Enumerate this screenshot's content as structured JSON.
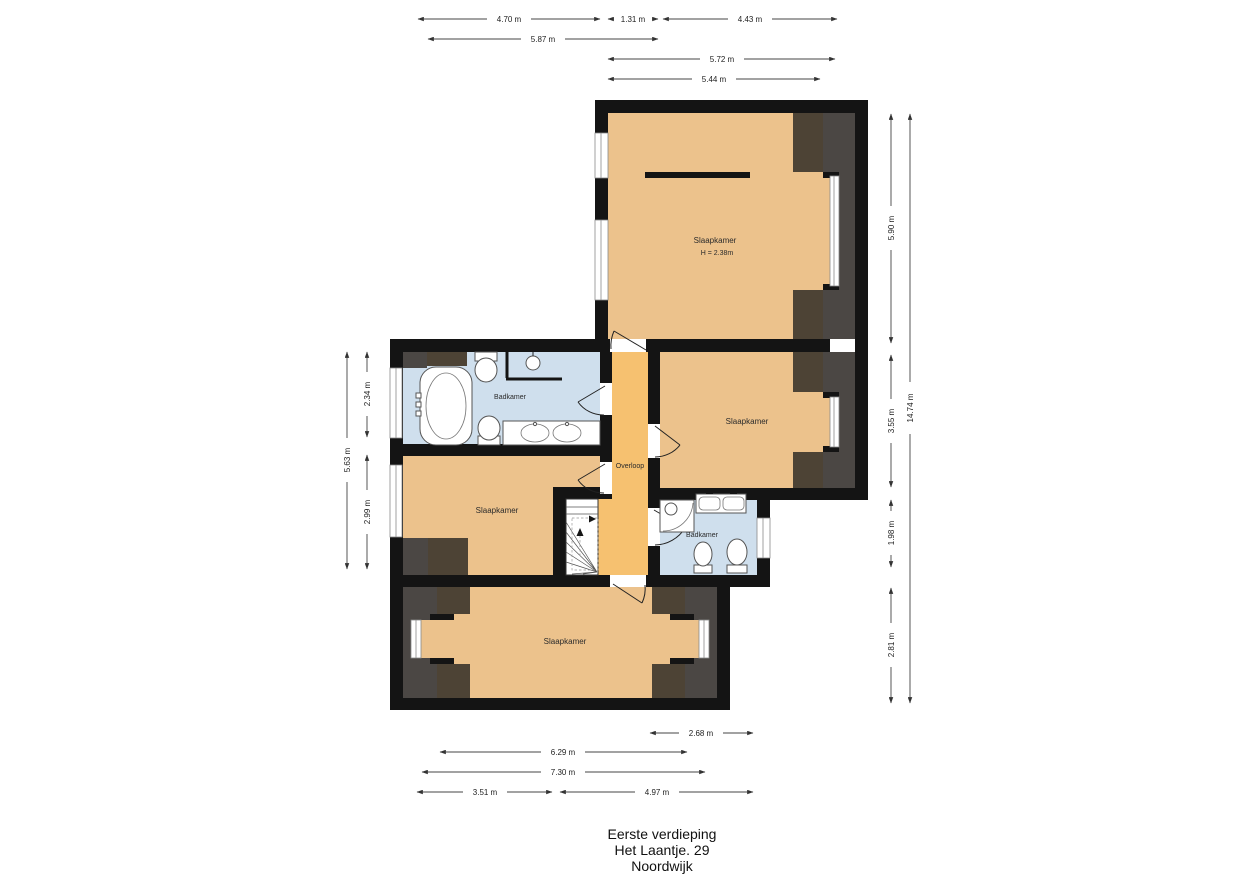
{
  "title": {
    "floor": "Eerste verdieping",
    "address": "Het Laantje. 29",
    "city": "Noordwijk"
  },
  "rooms": {
    "bedroom_top": {
      "label": "Slaapkamer",
      "height_note": "H = 2.38m"
    },
    "bathroom_top": {
      "label": "Badkamer"
    },
    "bedroom_right": {
      "label": "Slaapkamer"
    },
    "landing": {
      "label": "Overloop"
    },
    "bedroom_left": {
      "label": "Slaapkamer"
    },
    "bathroom_bottom": {
      "label": "Badkamer"
    },
    "bedroom_bottom": {
      "label": "Slaapkamer"
    }
  },
  "dimensions": {
    "top": [
      {
        "label": "4.70 m"
      },
      {
        "label": "1.31 m"
      },
      {
        "label": "4.43 m"
      },
      {
        "label": "5.87 m"
      },
      {
        "label": "5.72 m"
      },
      {
        "label": "5.44 m"
      }
    ],
    "right": [
      {
        "label": "5.90 m"
      },
      {
        "label": "3.55 m"
      },
      {
        "label": "1.98 m"
      },
      {
        "label": "2.81 m"
      },
      {
        "label": "14.74 m"
      }
    ],
    "left": [
      {
        "label": "5.63 m"
      },
      {
        "label": "2.34 m"
      },
      {
        "label": "2.99 m"
      }
    ],
    "bottom": [
      {
        "label": "2.68 m"
      },
      {
        "label": "6.29 m"
      },
      {
        "label": "7.30 m"
      },
      {
        "label": "3.51 m"
      },
      {
        "label": "4.97 m"
      }
    ]
  },
  "colors": {
    "wall": "#141414",
    "room_floor": "#ecc28c",
    "landing_floor": "#f6c170",
    "bathroom_floor": "#cfdfed",
    "attic_gray": "#4b4744",
    "attic_brown": "#4d4335"
  }
}
